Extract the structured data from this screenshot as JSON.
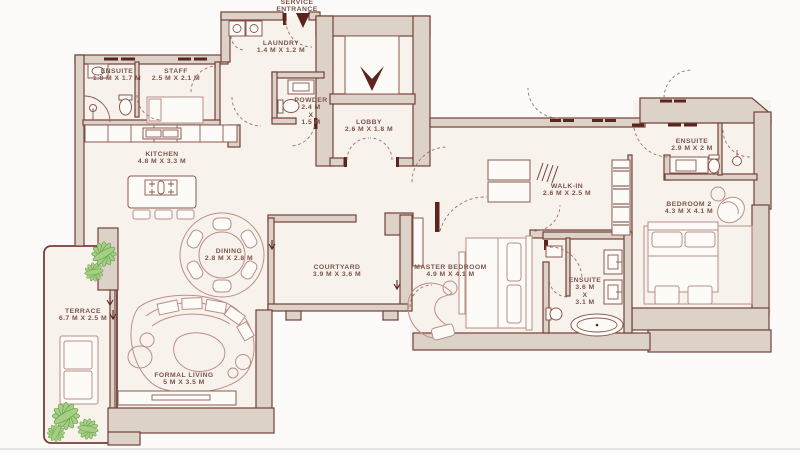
{
  "plan_title": "apartment-floor-plan",
  "entrance": {
    "line1": "SERVICE",
    "line2": "ENTRANCE"
  },
  "rooms": [
    {
      "id": "laundry",
      "name": "LAUNDRY",
      "dims": "1.4 M X 1.2 M"
    },
    {
      "id": "ensuite-staff",
      "name": "ENSUITE",
      "dims": "1.8 M X 1.7 M"
    },
    {
      "id": "staff",
      "name": "STAFF",
      "dims": "2.5 M X 2.1 M"
    },
    {
      "id": "powder",
      "name": "POWDER",
      "dims": "2.4 M",
      "dims2": "X",
      "dims3": "1.5 M"
    },
    {
      "id": "lobby",
      "name": "LOBBY",
      "dims": "2.6 M X 1.8 M"
    },
    {
      "id": "kitchen",
      "name": "KITCHEN",
      "dims": "4.8 M X 3.3 M"
    },
    {
      "id": "walk-in",
      "name": "WALK-IN",
      "dims": "2.6 M X 2.5 M"
    },
    {
      "id": "ensuite-bedroom2",
      "name": "ENSUITE",
      "dims": "2.9 M X 2 M"
    },
    {
      "id": "bedroom2",
      "name": "BEDROOM 2",
      "dims": "4.3 M X 4.1 M"
    },
    {
      "id": "dining",
      "name": "DINING",
      "dims": "2.8 M X 2.8 M"
    },
    {
      "id": "courtyard",
      "name": "COURTYARD",
      "dims": "3.9 M X 3.6 M"
    },
    {
      "id": "master-bedroom",
      "name": "MASTER BEDROOM",
      "dims": "4.9 M X 4.1 M"
    },
    {
      "id": "ensuite-master",
      "name": "ENSUITE",
      "dims": "3.6 M",
      "dims2": "X",
      "dims3": "3.1 M"
    },
    {
      "id": "terrace",
      "name": "TERRACE",
      "dims": "6.7 M X 2.5 M"
    },
    {
      "id": "formal-living",
      "name": "FORMAL LIVING",
      "dims": "5 M X 3.5 M"
    }
  ],
  "icons": {
    "elevator_arrow": "down-arrow",
    "entrance_arrow": "down-arrow",
    "step_arrows": "down-arrow"
  },
  "colors": {
    "wall_fill": "#DCD2C8",
    "wall_line": "#744038",
    "furniture_line": "#B98F88",
    "text": "#7D544C",
    "plant": "#A5CF83",
    "arrow_dark": "#5C241E",
    "floor": "#F8F2EC"
  }
}
